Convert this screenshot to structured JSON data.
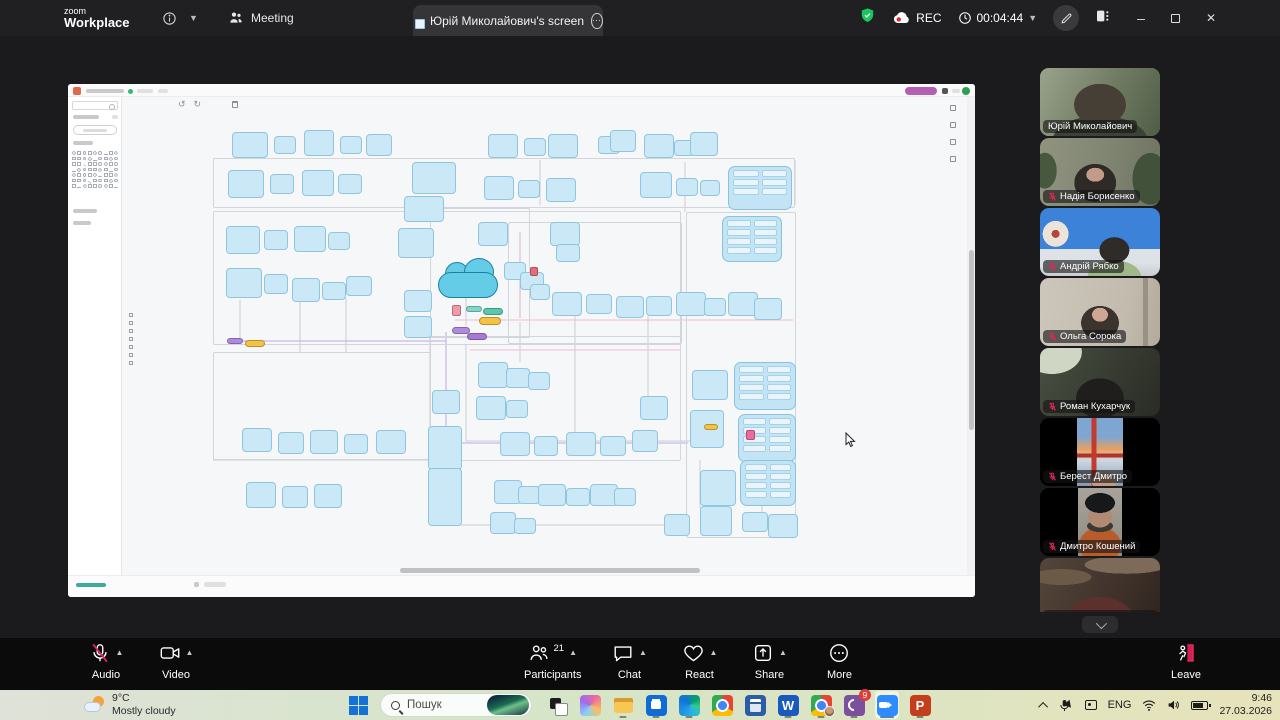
{
  "topbar": {
    "logo_line1": "zoom",
    "logo_line2": "Workplace",
    "meeting_tab_label": "Meeting",
    "screen_tab_title": "Юрій Миколайович's screen",
    "ellipsis": "⋯",
    "rec_label": "REC",
    "timer": "00:04:44",
    "minimize": "–",
    "close": "✕",
    "accent_green": "#23d959",
    "rec_red": "#e02525"
  },
  "participants_panel": {
    "participants": [
      {
        "name": "Юрій Миколайович",
        "muted": false,
        "active": true,
        "scene": "yurii",
        "narrow": false
      },
      {
        "name": "Надія Борисенко",
        "muted": true,
        "active": false,
        "scene": "nadiia",
        "narrow": false
      },
      {
        "name": "Андрій Рябко",
        "muted": true,
        "active": false,
        "scene": "andrii",
        "narrow": false
      },
      {
        "name": "Ольга Сорока",
        "muted": true,
        "active": false,
        "scene": "olha",
        "narrow": false
      },
      {
        "name": "Роман Кухарчук",
        "muted": true,
        "active": false,
        "scene": "roman",
        "narrow": false
      },
      {
        "name": "Берест Дмитро",
        "muted": true,
        "active": false,
        "scene": "berest",
        "narrow": true
      },
      {
        "name": "Дмитро Кошений",
        "muted": true,
        "active": false,
        "scene": "koshenii",
        "narrow": true
      },
      {
        "name": "Volodymyr Tolmachov",
        "muted": true,
        "active": false,
        "scene": "volodymyr",
        "narrow": false
      }
    ],
    "mute_red": "#e0255a"
  },
  "controls": {
    "left": [
      {
        "id": "audio",
        "label": "Audio",
        "icon": "mic-muted",
        "caret": true
      },
      {
        "id": "video",
        "label": "Video",
        "icon": "camera",
        "caret": true
      }
    ],
    "center": [
      {
        "id": "participants",
        "label": "Participants",
        "icon": "people",
        "badge": "21",
        "caret": true
      },
      {
        "id": "chat",
        "label": "Chat",
        "icon": "chat",
        "caret": true
      },
      {
        "id": "react",
        "label": "React",
        "icon": "heart",
        "caret": true
      },
      {
        "id": "share",
        "label": "Share",
        "icon": "share",
        "caret": true
      },
      {
        "id": "more",
        "label": "More",
        "icon": "more",
        "caret": false
      }
    ],
    "leave": {
      "id": "leave",
      "label": "Leave",
      "icon": "leave"
    }
  },
  "taskbar": {
    "weather_temp": "9°C",
    "weather_desc": "Mostly cloudy",
    "search_placeholder": "Пошук",
    "apps": [
      {
        "id": "taskview",
        "name": "task-view",
        "open": false
      },
      {
        "id": "copilot",
        "name": "copilot",
        "open": false
      },
      {
        "id": "explorer",
        "name": "file-explorer",
        "open": true
      },
      {
        "id": "store",
        "name": "microsoft-store",
        "open": true
      },
      {
        "id": "edge",
        "name": "edge",
        "open": true
      },
      {
        "id": "chrome",
        "name": "chrome",
        "open": false
      },
      {
        "id": "calc",
        "name": "calculator",
        "open": false
      },
      {
        "id": "word",
        "name": "word",
        "open": true,
        "glyph": "W"
      },
      {
        "id": "chrome2",
        "name": "chrome-profile",
        "open": true
      },
      {
        "id": "viber",
        "name": "viber",
        "open": true,
        "badge": "9"
      },
      {
        "id": "zoom",
        "name": "zoom",
        "open": true,
        "active": true
      },
      {
        "id": "ppt",
        "name": "powerpoint",
        "open": true,
        "glyph": "P"
      }
    ],
    "tray_lang": "ENG",
    "time": "9:46",
    "date": "27.03.2026",
    "zoom_blue": "#2d8cff"
  },
  "diagram": {
    "node_fill": "#cbe8f6",
    "node_border": "#8ec6e0",
    "cloud_fill": "#64cce6",
    "nodes": [
      [
        232,
        132,
        36,
        26
      ],
      [
        274,
        136,
        22,
        18
      ],
      [
        304,
        130,
        30,
        26
      ],
      [
        340,
        136,
        22,
        18
      ],
      [
        366,
        134,
        26,
        22
      ],
      [
        488,
        134,
        30,
        24
      ],
      [
        524,
        138,
        22,
        18
      ],
      [
        548,
        134,
        30,
        24
      ],
      [
        598,
        136,
        22,
        18
      ],
      [
        610,
        130,
        26,
        22
      ],
      [
        644,
        134,
        30,
        24
      ],
      [
        674,
        140,
        20,
        16
      ],
      [
        690,
        132,
        28,
        24
      ],
      [
        228,
        170,
        36,
        28
      ],
      [
        270,
        174,
        24,
        20
      ],
      [
        302,
        170,
        32,
        26
      ],
      [
        338,
        174,
        24,
        20
      ],
      [
        412,
        162,
        44,
        32
      ],
      [
        404,
        196,
        40,
        26
      ],
      [
        484,
        176,
        30,
        24
      ],
      [
        518,
        180,
        22,
        18
      ],
      [
        546,
        178,
        30,
        24
      ],
      [
        640,
        172,
        32,
        26
      ],
      [
        676,
        178,
        22,
        18
      ],
      [
        700,
        180,
        20,
        16
      ],
      [
        226,
        226,
        34,
        28
      ],
      [
        264,
        230,
        24,
        20
      ],
      [
        294,
        226,
        32,
        26
      ],
      [
        328,
        232,
        22,
        18
      ],
      [
        398,
        228,
        36,
        30
      ],
      [
        478,
        222,
        30,
        24
      ],
      [
        550,
        222,
        30,
        24
      ],
      [
        556,
        244,
        24,
        18
      ],
      [
        226,
        268,
        36,
        30
      ],
      [
        264,
        274,
        24,
        20
      ],
      [
        292,
        278,
        28,
        24
      ],
      [
        322,
        282,
        24,
        18
      ],
      [
        346,
        276,
        26,
        20
      ],
      [
        504,
        262,
        22,
        18
      ],
      [
        520,
        272,
        24,
        18
      ],
      [
        530,
        284,
        20,
        16
      ],
      [
        404,
        290,
        28,
        22
      ],
      [
        404,
        316,
        28,
        22
      ],
      [
        552,
        292,
        30,
        24
      ],
      [
        586,
        294,
        26,
        20
      ],
      [
        616,
        296,
        28,
        22
      ],
      [
        646,
        296,
        26,
        20
      ],
      [
        676,
        292,
        30,
        24
      ],
      [
        704,
        298,
        22,
        18
      ],
      [
        728,
        292,
        30,
        24
      ],
      [
        754,
        298,
        28,
        22
      ],
      [
        478,
        362,
        30,
        26
      ],
      [
        506,
        368,
        24,
        20
      ],
      [
        528,
        372,
        22,
        18
      ],
      [
        432,
        390,
        28,
        24
      ],
      [
        476,
        396,
        30,
        24
      ],
      [
        506,
        400,
        22,
        18
      ],
      [
        640,
        396,
        28,
        24
      ],
      [
        692,
        370,
        36,
        30
      ],
      [
        242,
        428,
        30,
        24
      ],
      [
        278,
        432,
        26,
        22
      ],
      [
        310,
        430,
        28,
        24
      ],
      [
        344,
        434,
        24,
        20
      ],
      [
        376,
        430,
        30,
        24
      ],
      [
        428,
        426,
        34,
        44
      ],
      [
        500,
        432,
        30,
        24
      ],
      [
        534,
        436,
        24,
        20
      ],
      [
        566,
        432,
        30,
        24
      ],
      [
        600,
        436,
        26,
        20
      ],
      [
        632,
        430,
        26,
        22
      ],
      [
        690,
        410,
        34,
        38
      ],
      [
        246,
        482,
        30,
        26
      ],
      [
        282,
        486,
        26,
        22
      ],
      [
        314,
        484,
        28,
        24
      ],
      [
        428,
        468,
        34,
        58
      ],
      [
        494,
        480,
        28,
        24
      ],
      [
        518,
        486,
        22,
        18
      ],
      [
        538,
        484,
        28,
        22
      ],
      [
        566,
        488,
        24,
        18
      ],
      [
        590,
        484,
        28,
        22
      ],
      [
        614,
        488,
        22,
        18
      ],
      [
        700,
        470,
        36,
        36
      ],
      [
        490,
        512,
        26,
        22
      ],
      [
        514,
        518,
        22,
        16
      ],
      [
        664,
        514,
        26,
        22
      ],
      [
        700,
        506,
        32,
        30
      ],
      [
        742,
        512,
        26,
        20
      ],
      [
        768,
        514,
        30,
        24
      ]
    ],
    "containers": [
      [
        728,
        166,
        64,
        44
      ],
      [
        722,
        216,
        60,
        46
      ],
      [
        734,
        362,
        62,
        48
      ],
      [
        738,
        414,
        58,
        48
      ],
      [
        740,
        460,
        56,
        46
      ]
    ],
    "group_rects": [
      [
        213,
        158,
        582,
        50
      ],
      [
        213,
        211,
        468,
        134
      ],
      [
        430,
        336,
        251,
        125
      ],
      [
        213,
        352,
        218,
        108
      ],
      [
        686,
        212,
        110,
        326
      ],
      [
        430,
        208,
        100,
        130
      ],
      [
        508,
        222,
        174,
        122
      ]
    ],
    "edges": [
      {
        "color": "#c9ccd1",
        "points": "466,298 466,326"
      },
      {
        "color": "#c9ccd1",
        "points": "466,345 466,441 690,441"
      },
      {
        "color": "#c9ccd1",
        "points": "430,322 430,468"
      },
      {
        "color": "#c9ccd1",
        "points": "460,470 460,525 664,525"
      },
      {
        "color": "#c9ccd1",
        "points": "520,322 520,362"
      },
      {
        "color": "#c9ccd1",
        "points": "540,205 540,160"
      },
      {
        "color": "#c9ccd1",
        "points": "685,162 685,212"
      },
      {
        "color": "#c9ccd1",
        "points": "700,460 700,508"
      },
      {
        "color": "#c9ccd1",
        "points": "240,300 240,340"
      },
      {
        "color": "#c9ccd1",
        "points": "300,300 300,352"
      },
      {
        "color": "#c9ccd1",
        "points": "346,298 346,352"
      },
      {
        "color": "#c9ccd1",
        "points": "575,316 575,432"
      },
      {
        "color": "#c9ccd1",
        "points": "648,316 648,398"
      },
      {
        "color": "#c9ccd1",
        "points": "762,460 762,512"
      },
      {
        "color": "#c9ccd1",
        "points": "795,160 795,205"
      },
      {
        "color": "#c9ccd1",
        "points": "213,460 430,460"
      },
      {
        "color": "#eebbd4",
        "points": "455,320 793,320"
      },
      {
        "color": "#eebbd4",
        "points": "470,350 680,350"
      },
      {
        "color": "#c3a6e3",
        "points": "446,332 446,443"
      },
      {
        "color": "#c3a6e3",
        "points": "446,443 688,443"
      },
      {
        "color": "#c3a6e3",
        "points": "236,341 446,341"
      },
      {
        "color": "#d8b0cc",
        "points": "520,232 520,318"
      }
    ],
    "accents": [
      {
        "x": 466,
        "y": 306,
        "w": 16,
        "h": 6,
        "color": "#7fd8c8",
        "shape": "pill"
      },
      {
        "x": 483,
        "y": 308,
        "w": 20,
        "h": 7,
        "color": "#5bc8ac",
        "shape": "pill"
      },
      {
        "x": 479,
        "y": 317,
        "w": 22,
        "h": 8,
        "color": "#f5c242",
        "shape": "pill"
      },
      {
        "x": 452,
        "y": 327,
        "w": 18,
        "h": 7,
        "color": "#b08ae0",
        "shape": "pill"
      },
      {
        "x": 467,
        "y": 333,
        "w": 20,
        "h": 7,
        "color": "#a678d8",
        "shape": "pill"
      },
      {
        "x": 227,
        "y": 338,
        "w": 16,
        "h": 6,
        "color": "#b08ae0",
        "shape": "pill"
      },
      {
        "x": 245,
        "y": 340,
        "w": 20,
        "h": 7,
        "color": "#f5c242",
        "shape": "pill"
      },
      {
        "x": 704,
        "y": 424,
        "w": 14,
        "h": 6,
        "color": "#f5c242",
        "shape": "pill"
      },
      {
        "x": 452,
        "y": 305,
        "w": 9,
        "h": 11,
        "color": "#ef9aa8",
        "shape": "chip"
      },
      {
        "x": 530,
        "y": 267,
        "w": 8,
        "h": 9,
        "color": "#e86a7a",
        "shape": "chip"
      },
      {
        "x": 746,
        "y": 430,
        "w": 9,
        "h": 10,
        "color": "#ef6a9a",
        "shape": "chip"
      }
    ],
    "shape_grid": {
      "cols": 9,
      "rows": 7
    }
  }
}
